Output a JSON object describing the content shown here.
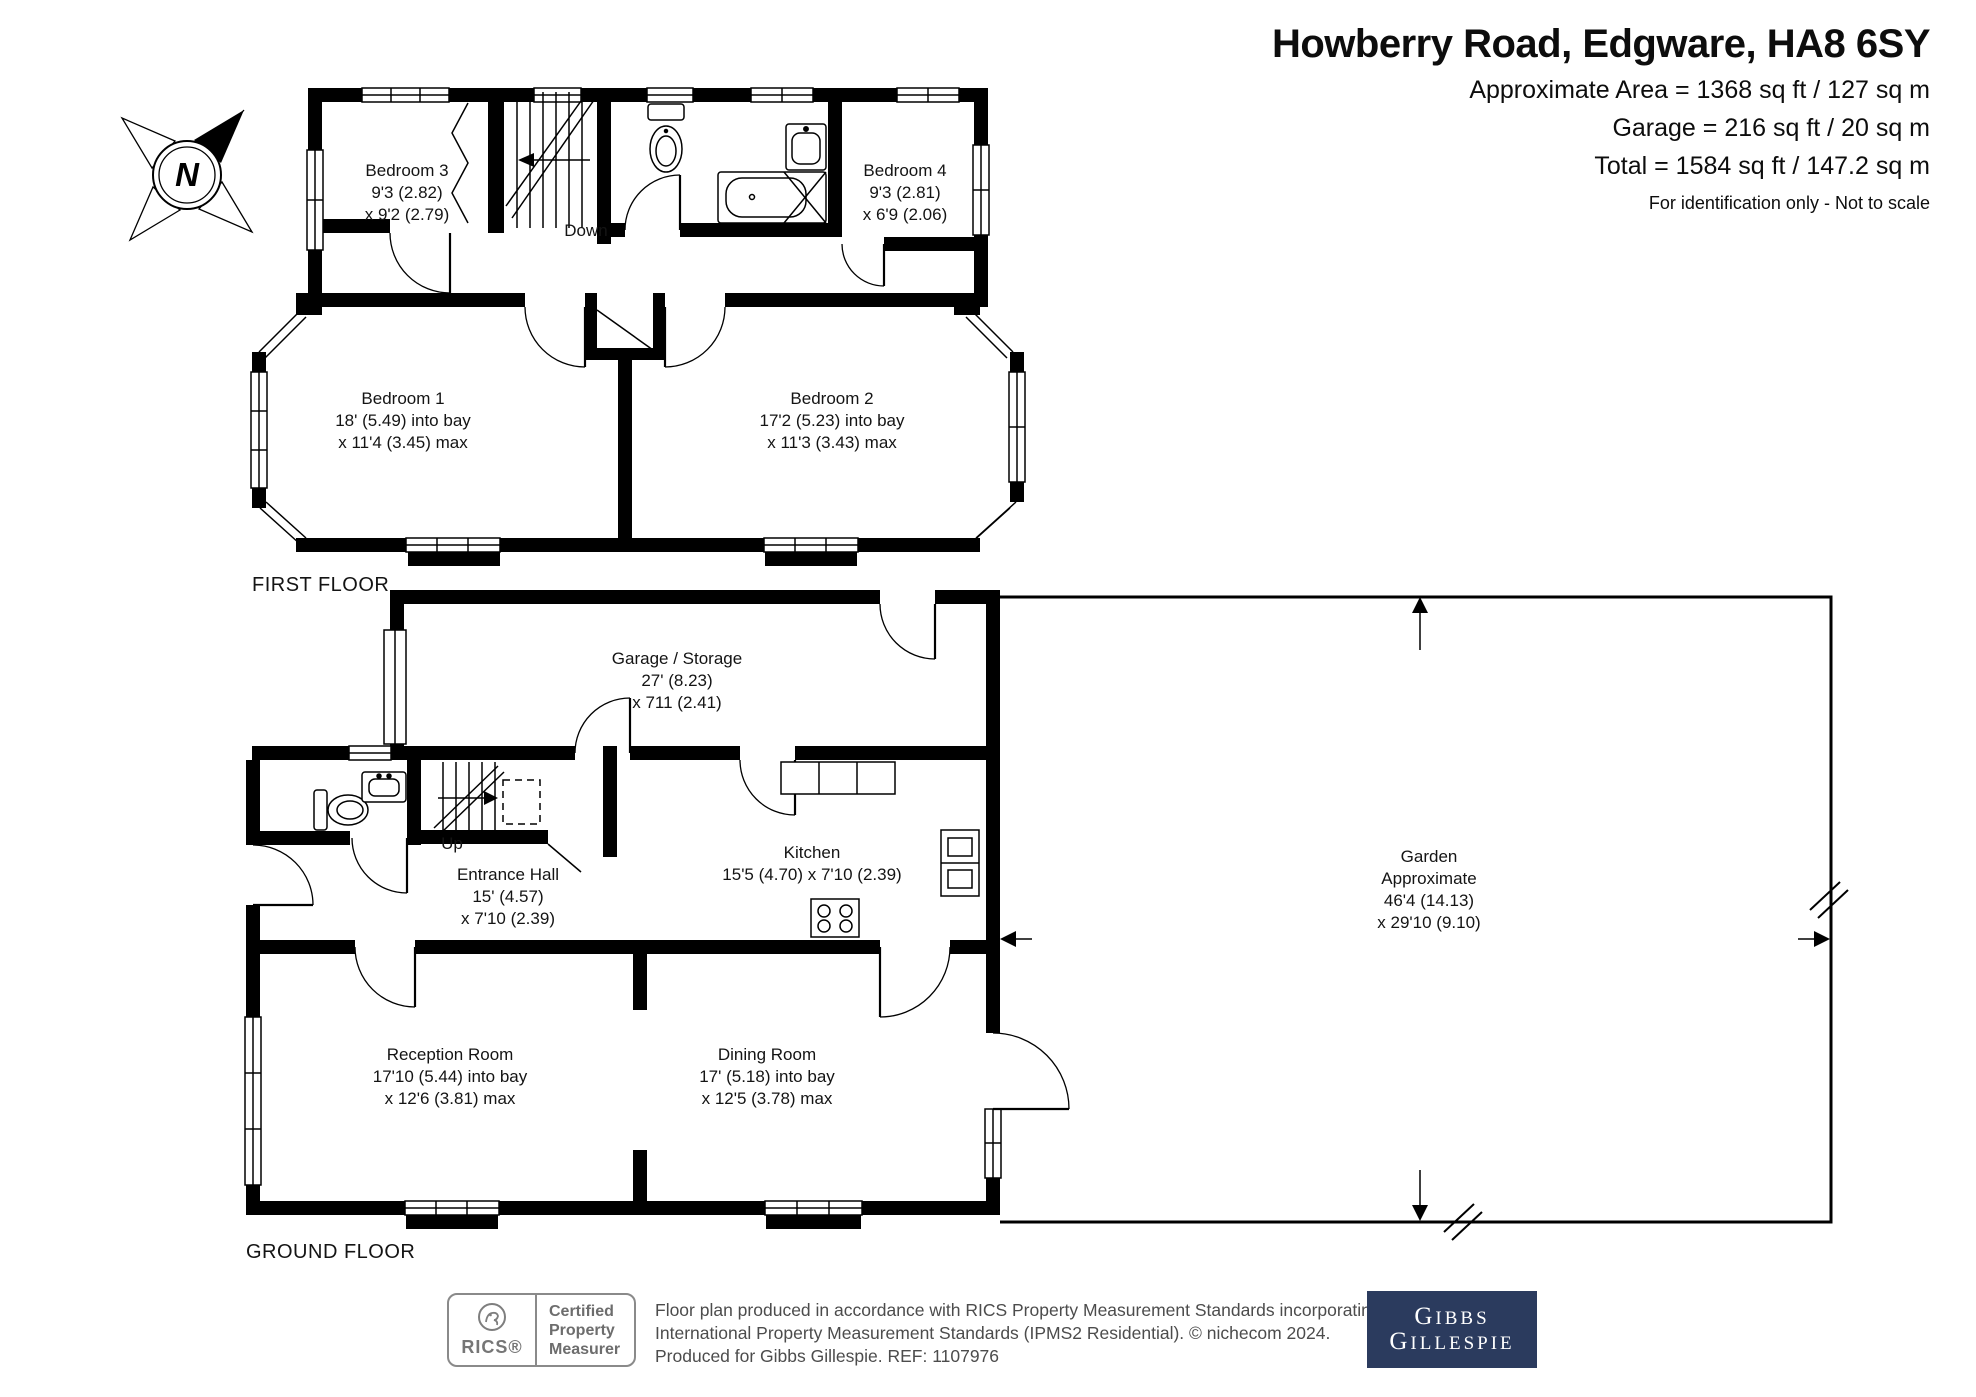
{
  "header": {
    "title": "Howberry Road, Edgware, HA8 6SY",
    "area_lines": [
      "Approximate Area = 1368 sq ft / 127 sq m",
      "Garage = 216 sq ft / 20 sq m",
      "Total = 1584 sq ft / 147.2 sq m"
    ],
    "note": "For identification only - Not to scale"
  },
  "compass": {
    "north_label": "N"
  },
  "floor_labels": {
    "first": "FIRST FLOOR",
    "ground": "GROUND FLOOR"
  },
  "rooms": {
    "bedroom3": {
      "name": "Bedroom 3",
      "dims": [
        "9'3 (2.82)",
        "x 9'2 (2.79)"
      ]
    },
    "bedroom4": {
      "name": "Bedroom 4",
      "dims": [
        "9'3 (2.81)",
        "x 6'9 (2.06)"
      ]
    },
    "bedroom1": {
      "name": "Bedroom 1",
      "dims": [
        "18' (5.49) into bay",
        "x 11'4 (3.45) max"
      ]
    },
    "bedroom2": {
      "name": "Bedroom 2",
      "dims": [
        "17'2 (5.23) into bay",
        "x 11'3 (3.43) max"
      ]
    },
    "garage": {
      "name": "Garage / Storage",
      "dims": [
        "27' (8.23)",
        "x 711 (2.41)"
      ]
    },
    "entrance_hall": {
      "name": "Entrance Hall",
      "dims": [
        "15' (4.57)",
        "x 7'10 (2.39)"
      ]
    },
    "kitchen": {
      "name": "Kitchen",
      "dims": [
        "15'5 (4.70) x 7'10 (2.39)"
      ]
    },
    "garden": {
      "name": "Garden",
      "dims": [
        "Approximate",
        "46'4 (14.13)",
        "x 29'10 (9.10)"
      ]
    },
    "reception": {
      "name": "Reception Room",
      "dims": [
        "17'10 (5.44) into bay",
        "x 12'6 (3.81) max"
      ]
    },
    "dining": {
      "name": "Dining Room",
      "dims": [
        "17' (5.18) into bay",
        "x 12'5 (3.78) max"
      ]
    }
  },
  "stairs": {
    "first_floor": "Down",
    "ground_floor": "Up"
  },
  "footer": {
    "rics_badge": {
      "brand": "RICS®",
      "title_lines": [
        "Certified",
        "Property",
        "Measurer"
      ]
    },
    "disclaimer_lines": [
      "Floor plan produced in accordance with RICS Property Measurement Standards incorporating",
      "International Property Measurement Standards (IPMS2 Residential).  © nichecom 2024.",
      "Produced for Gibbs Gillespie.  REF: 1107976"
    ],
    "agent_logo": {
      "line1": "Gibbs",
      "line2": "Gillespie"
    }
  },
  "colors": {
    "wall": "#000000",
    "agent_navy": "#2b3b5e",
    "rics_gray": "#7e7e7e",
    "footer_text": "#4c4c4c"
  }
}
